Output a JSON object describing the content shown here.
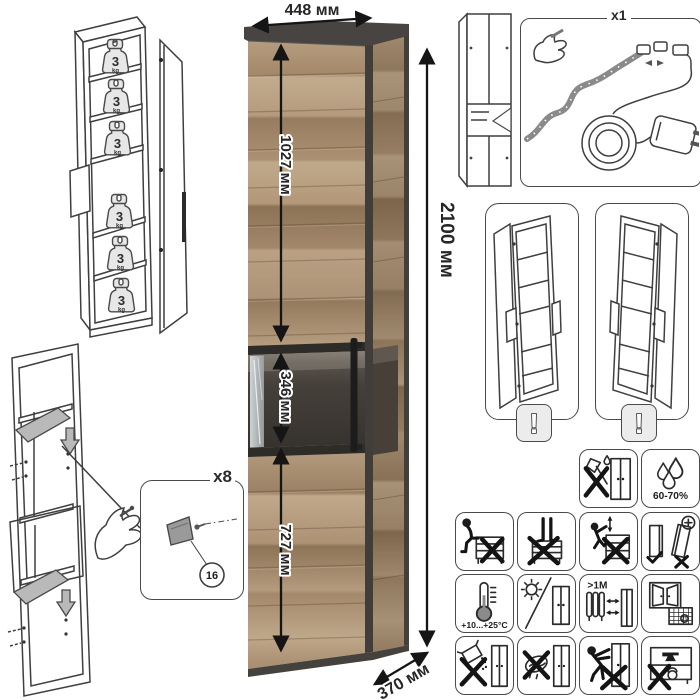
{
  "dimensions": {
    "width": "448 мм",
    "height": "2100 мм",
    "depth": "370 мм",
    "upper_section": "1027 мм",
    "glass_section": "346 мм",
    "lower_section": "727 мм"
  },
  "shelf_load": {
    "count": 6,
    "value": "3",
    "unit": "kg"
  },
  "assembly": {
    "fasteners_qty": "x8",
    "part_number": "16"
  },
  "led_kit": {
    "qty": "x1"
  },
  "warnings": {
    "exclamation": "!"
  },
  "care": {
    "humidity": "60-70%",
    "temperature": "+10...+25°C",
    "heat_distance": ">1M",
    "calendar_day": "21"
  },
  "colors": {
    "wood_light": "#c1aa8b",
    "wood_mid": "#a78c6e",
    "wood_dark": "#8d7355",
    "frame_graphite": "#474441",
    "glass_interior": "#3c3833",
    "line_drawing": "#3f3f3f"
  }
}
